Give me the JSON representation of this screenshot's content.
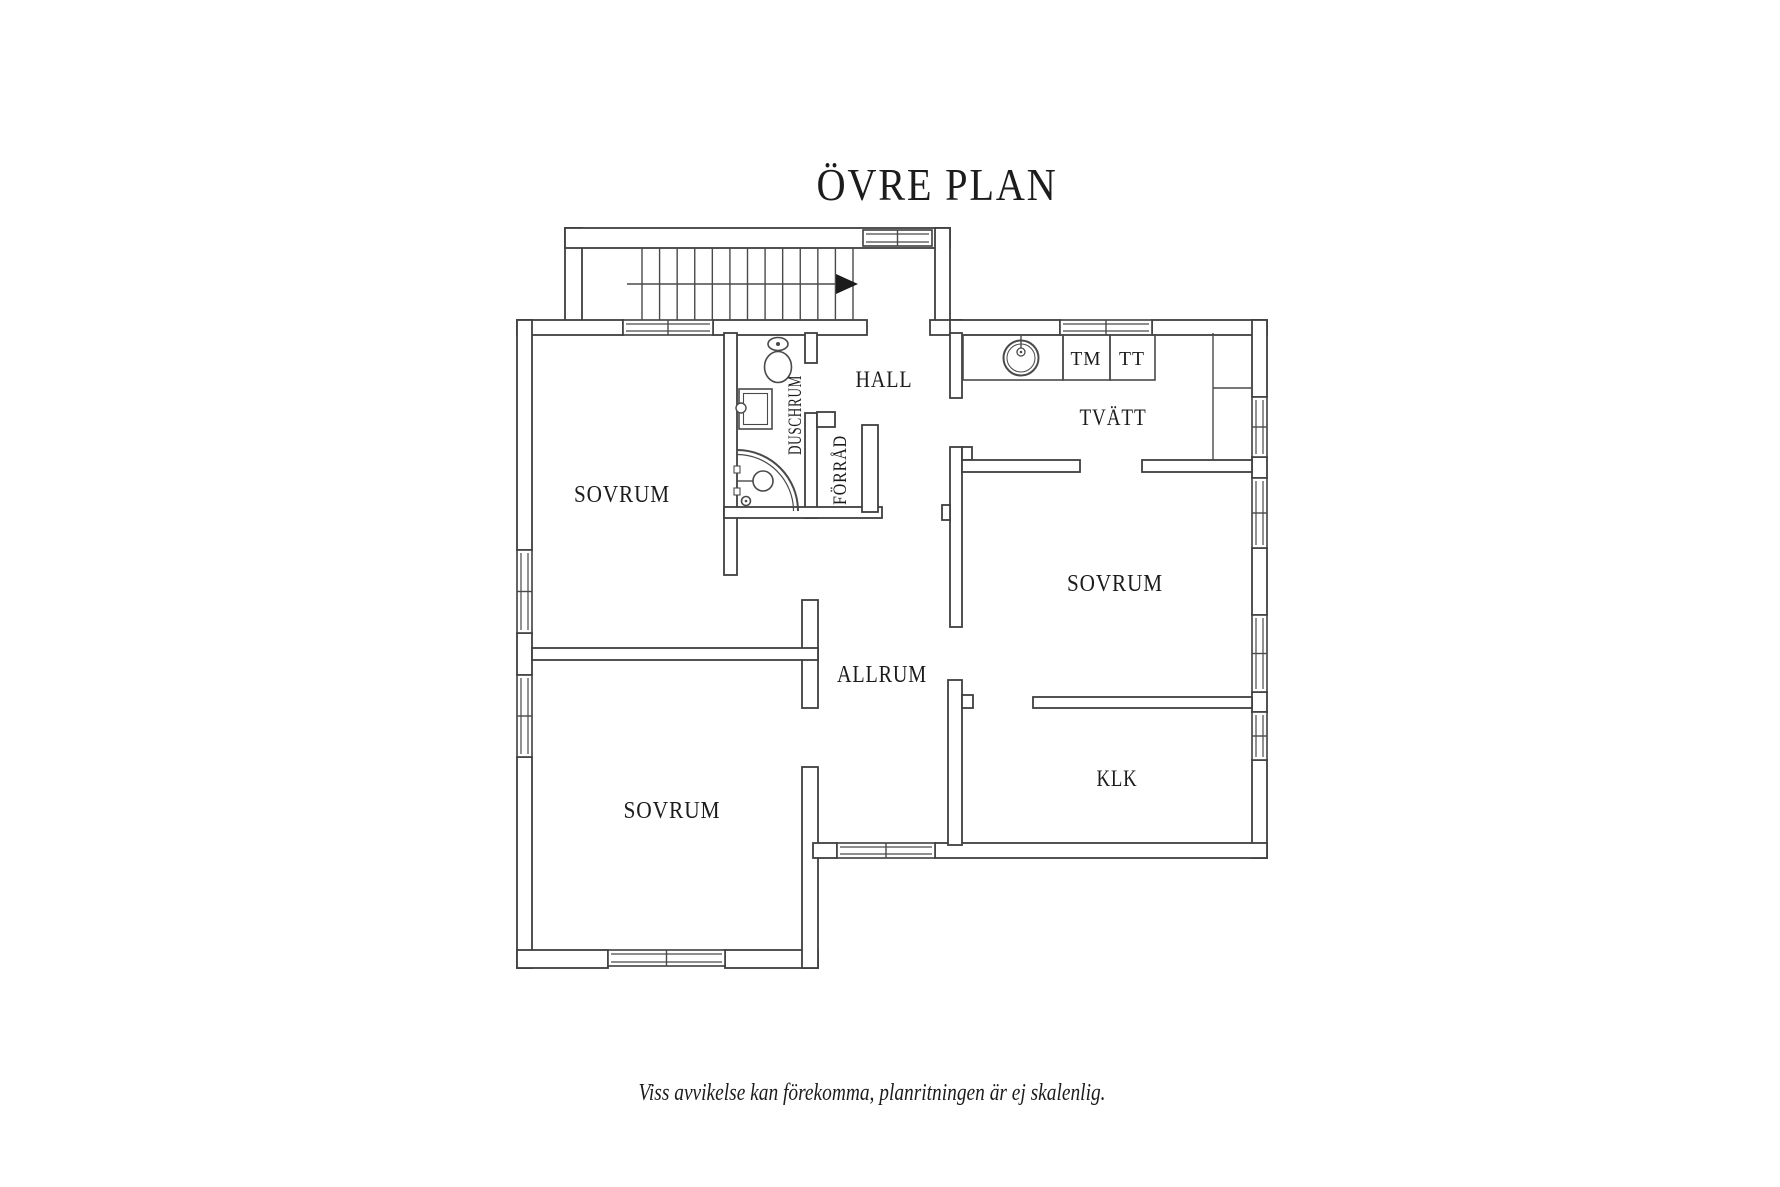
{
  "title": "ÖVRE PLAN",
  "footer": "Viss avvikelse kan förekomma, planritningen är ej skalenlig.",
  "rooms": {
    "sovrum_tl": "SOVRUM",
    "sovrum_bl": "SOVRUM",
    "sovrum_r": "SOVRUM",
    "hall": "HALL",
    "tvatt": "TVÄTT",
    "allrum": "ALLRUM",
    "klk": "KLK",
    "duschrum": "DUSCHRUM",
    "forrad": "FÖRRÅD"
  },
  "appliances": {
    "tm": "TM",
    "tt": "TT"
  },
  "fixtures": [
    "stairs-up-arrow",
    "toilet",
    "washbasin",
    "corner-shower",
    "laundry-sink",
    "wardrobe-cabinet"
  ],
  "colors": {
    "wall_line": "#3f3f3f",
    "thin_line": "#4a4a4a",
    "text": "#1c1c1c",
    "background": "#ffffff"
  }
}
